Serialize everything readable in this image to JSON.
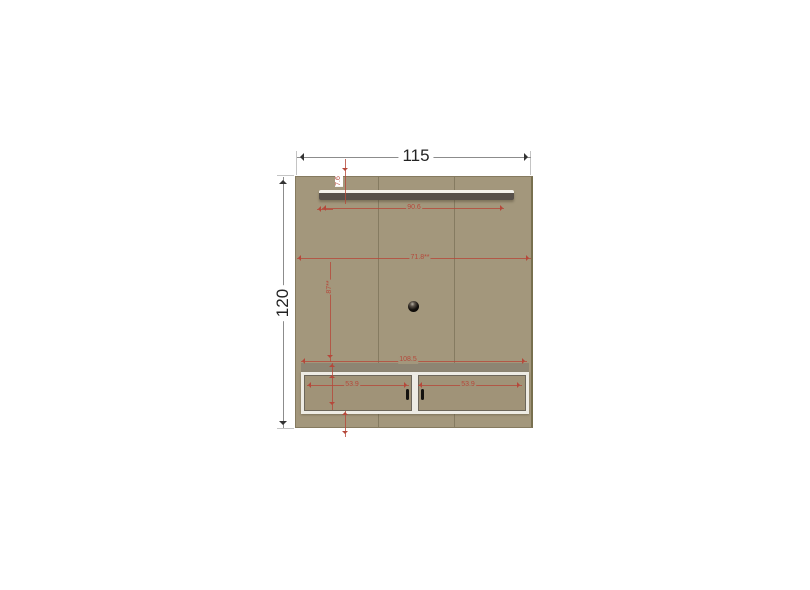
{
  "diagram": {
    "type": "furniture-dimension-drawing",
    "object": "tv-wall-panel-with-shelf-and-cabinet",
    "dimensions": {
      "overall_width": "115",
      "overall_height": "120",
      "shelf_length": "90.6",
      "shelf_drop": "7.6",
      "mid_width": "71.8**",
      "upper_section_height": "87**",
      "cabinet_width": "108.5",
      "cabinet_left_compartment": "53.9",
      "cabinet_right_compartment": "53.9"
    },
    "colors": {
      "background": "#ffffff",
      "panel": "#a3977c",
      "shelf_dark": "#57504a",
      "shelf_highlight": "#f4f2ec",
      "cabinet_frame": "#edebe4",
      "cabinet_inner_line": "#6c665a",
      "dimension_black": "#232323",
      "dimension_red": "#b5483a"
    }
  }
}
